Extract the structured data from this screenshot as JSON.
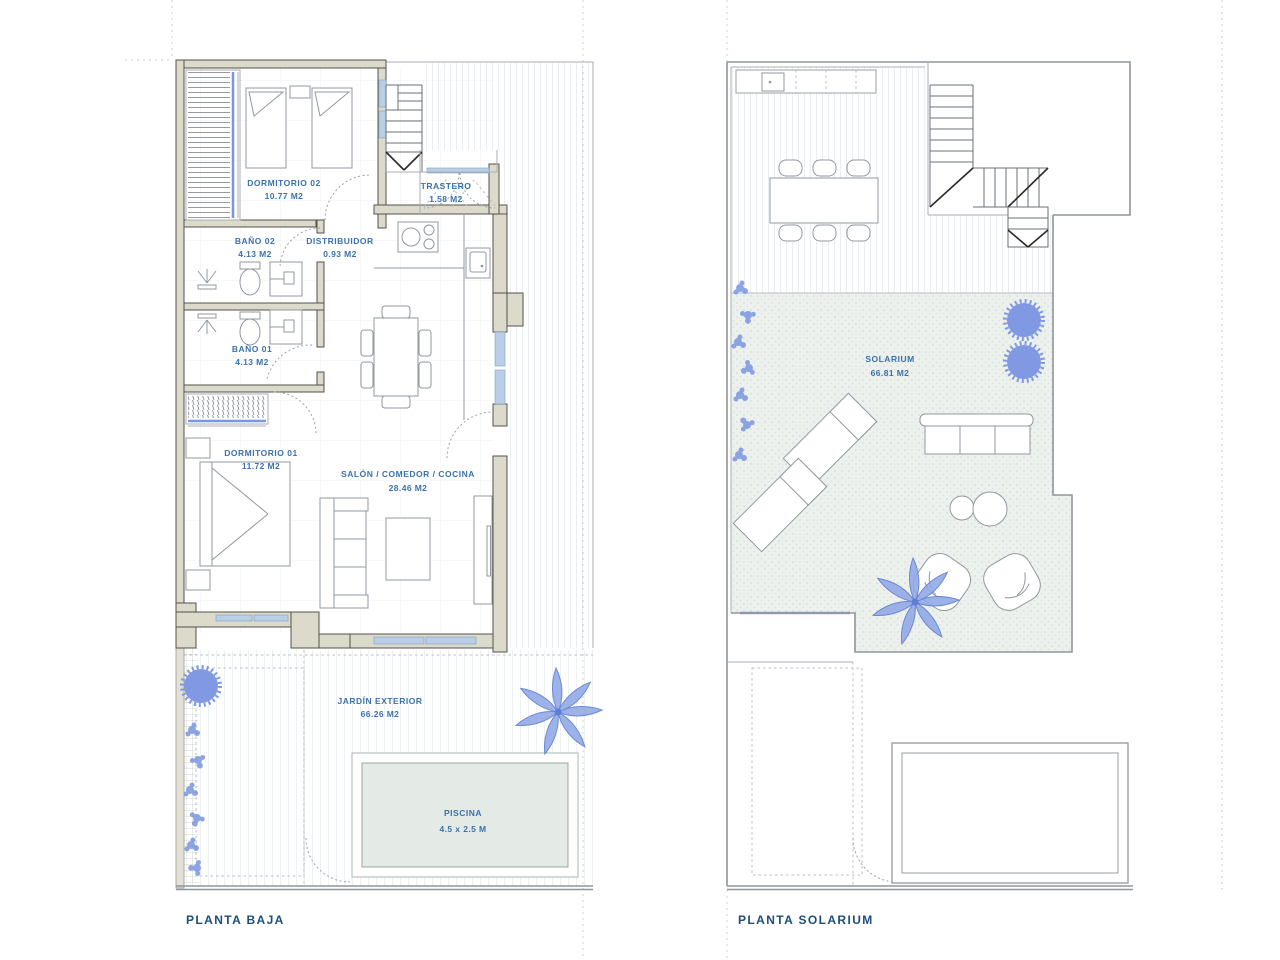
{
  "document": {
    "type": "architectural-floor-plans",
    "background": "#ffffff"
  },
  "colors": {
    "label_blue": "#3a72ab",
    "title_blue": "#1d4d7d",
    "wall_fill": "#dcdacb",
    "wall_stroke": "#55524a",
    "window_blue": "#b9cfe8",
    "plant_blue": "#7b96e0",
    "pool_water": "#e4eae5",
    "hatch_gray": "#d7dde2",
    "solarium_texture": "#edf1ed"
  },
  "plans": [
    {
      "id": "planta-baja",
      "title": "PLANTA BAJA",
      "rooms": [
        {
          "name": "DORMITORIO 02",
          "area": "10.77 M2"
        },
        {
          "name": "TRASTERO",
          "area": "1.58 M2"
        },
        {
          "name": "BAÑO 02",
          "area": "4.13 M2"
        },
        {
          "name": "DISTRIBUIDOR",
          "area": "0.93 M2"
        },
        {
          "name": "BAÑO 01",
          "area": "4.13 M2"
        },
        {
          "name": "DORMITORIO 01",
          "area": "11.72 M2"
        },
        {
          "name": "SALÓN / COMEDOR / COCINA",
          "area": "28.46 M2"
        },
        {
          "name": "JARDÍN EXTERIOR",
          "area": "66.26 M2"
        },
        {
          "name": "PISCINA",
          "area": "4.5 x 2.5 M"
        }
      ]
    },
    {
      "id": "planta-solarium",
      "title": "PLANTA SOLARIUM",
      "rooms": [
        {
          "name": "SOLARIUM",
          "area": "66.81 M2"
        }
      ]
    }
  ]
}
